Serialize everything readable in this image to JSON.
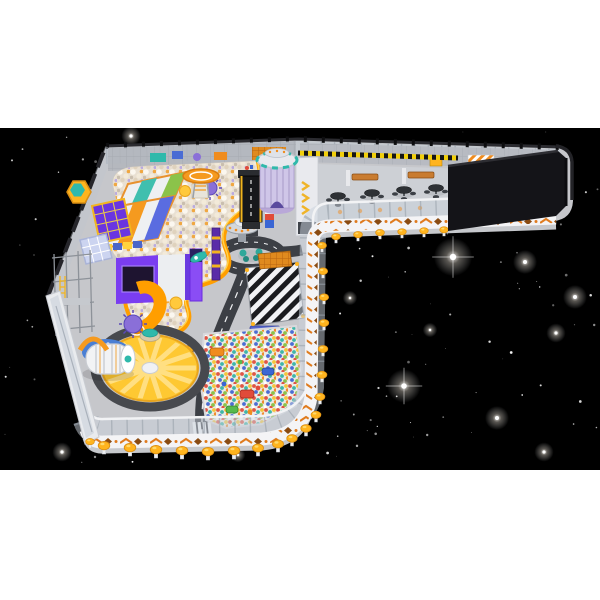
{
  "scene": {
    "kind": "3d-render-space-theme-indoor-playground",
    "background": {
      "page_bg": "#ffffff",
      "space_bg": "#000000",
      "band_top": 128,
      "band_height": 342
    },
    "stars": {
      "faint_count": 150,
      "faint_color": "#ffffff",
      "bright": [
        {
          "x": 399,
          "y": 218,
          "r": 9,
          "flare": false
        },
        {
          "x": 447,
          "y": 209,
          "r": 5,
          "flare": false
        },
        {
          "x": 453,
          "y": 257,
          "r": 8,
          "flare": true
        },
        {
          "x": 525,
          "y": 262,
          "r": 5,
          "flare": false
        },
        {
          "x": 404,
          "y": 386,
          "r": 7,
          "flare": true
        },
        {
          "x": 497,
          "y": 418,
          "r": 5,
          "flare": false
        },
        {
          "x": 556,
          "y": 333,
          "r": 4,
          "flare": false
        },
        {
          "x": 131,
          "y": 136,
          "r": 4,
          "flare": false
        },
        {
          "x": 62,
          "y": 452,
          "r": 4,
          "flare": false
        },
        {
          "x": 238,
          "y": 455,
          "r": 3,
          "flare": false
        },
        {
          "x": 544,
          "y": 452,
          "r": 4,
          "flare": false
        },
        {
          "x": 575,
          "y": 297,
          "r": 5,
          "flare": false
        },
        {
          "x": 350,
          "y": 298,
          "r": 3,
          "flare": false
        },
        {
          "x": 430,
          "y": 330,
          "r": 3,
          "flare": false
        }
      ]
    },
    "palette": {
      "floor": "#c6c7cb",
      "corridorFloor": "#cdd0d5",
      "backZone": "#b4b8bf",
      "wallWhite": "#e9eaee",
      "glass": "rgba(200,208,218,0.5)",
      "railDark": "#2b2b30",
      "hazardYellow": "#f2cf0a",
      "accentOrange": "#f59a1f",
      "brightOrange": "#ff9e00",
      "deepOrange": "#c96a1e",
      "postYellow": "#ffb41e",
      "road": "#3c3f45",
      "roadLine": "#f0f1f3",
      "ballPitBeige": "#e9e0d2",
      "carouselYellow": "#fec832",
      "carouselStripe": "#ffdf82",
      "purple": "#7a3df0",
      "teal": "#2fb9ab",
      "darkBox": "#141418",
      "dividerTan": "#d9a765",
      "toyRed": "#e04b3a",
      "toyBlue": "#3a66d4",
      "toyGreen": "#57b94c",
      "silver": "#d4d7dc"
    },
    "objects": [
      "starfield",
      "space-tower",
      "helipad-platform",
      "drop-slide",
      "multi-lane-slide",
      "trampoline-court",
      "hexagon-trampoline",
      "climbing-frame",
      "projection-room",
      "purple-slide",
      "spiral-tube-slide",
      "soft-roller-capsule",
      "sunburst-carousel",
      "white-ball-pit",
      "rainbow-ball-pit",
      "toy-road-track",
      "roundabout",
      "crosswalk-plaza",
      "ufo-spinner-ride",
      "stacked-toy-figure",
      "toy-excavator",
      "toy-rocket",
      "totem-pole",
      "cafe-seating",
      "glass-perimeter-wall",
      "decorated-parapet",
      "mushroom-stools",
      "service-block",
      "hazard-strip"
    ],
    "stools": [
      [
        90,
        448,
        0.8
      ],
      [
        104,
        454,
        1.05
      ],
      [
        130,
        456,
        1.05
      ],
      [
        156,
        458,
        1.05
      ],
      [
        182,
        459,
        1.05
      ],
      [
        208,
        460,
        1.05
      ],
      [
        234,
        459,
        1.05
      ],
      [
        258,
        456,
        1.0
      ],
      [
        278,
        452,
        1.0
      ],
      [
        292,
        446,
        0.95
      ],
      [
        306,
        436,
        0.95
      ],
      [
        316,
        422,
        0.9
      ],
      [
        320,
        404,
        0.9
      ],
      [
        322,
        382,
        0.9
      ],
      [
        323,
        356,
        0.88
      ],
      [
        324,
        330,
        0.88
      ],
      [
        324,
        304,
        0.85
      ],
      [
        323,
        278,
        0.85
      ],
      [
        322,
        252,
        0.82
      ],
      [
        336,
        243,
        0.8
      ],
      [
        358,
        241,
        0.8
      ],
      [
        380,
        239,
        0.8
      ],
      [
        402,
        238,
        0.78
      ],
      [
        424,
        237,
        0.78
      ],
      [
        444,
        236,
        0.78
      ]
    ],
    "carousel": {
      "cx": 150,
      "cy": 368,
      "rx": 46,
      "ry": 31,
      "stripes": 14
    }
  }
}
